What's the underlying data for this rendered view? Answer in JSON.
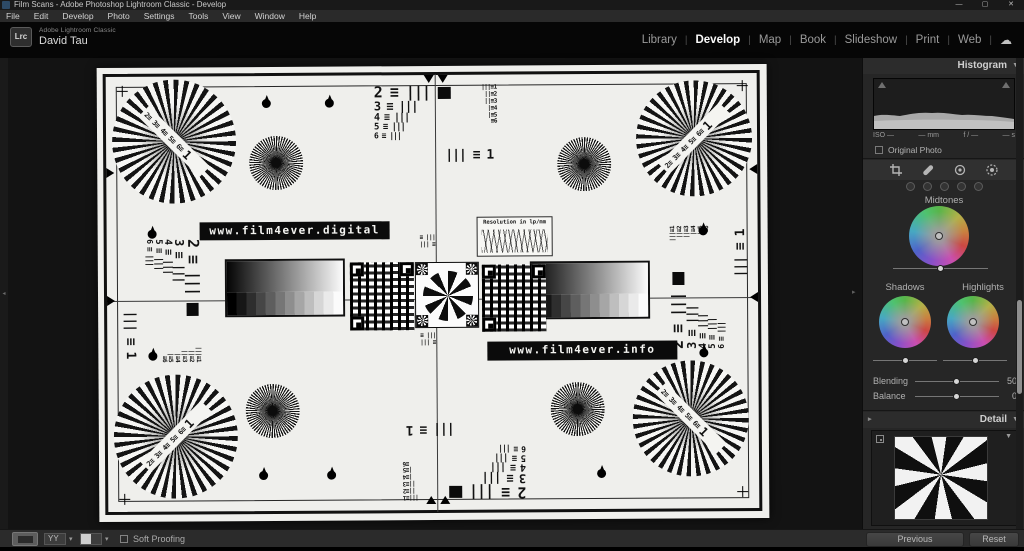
{
  "window": {
    "title": "Film Scans - Adobe Photoshop Lightroom Classic - Develop",
    "minimize": "—",
    "maximize": "▢",
    "close": "✕"
  },
  "menu": {
    "items": [
      "File",
      "Edit",
      "Develop",
      "Photo",
      "Settings",
      "Tools",
      "View",
      "Window",
      "Help"
    ]
  },
  "identity": {
    "logo_text": "Lrc",
    "app_name": "Adobe Lightroom Classic",
    "user_name": "David Tau"
  },
  "modules": {
    "items": [
      "Library",
      "Develop",
      "Map",
      "Book",
      "Slideshow",
      "Print",
      "Web"
    ],
    "active": "Develop",
    "cloud_icon": "☁",
    "separator": "|"
  },
  "panels": {
    "histogram": {
      "title": "Histogram",
      "disclosure": "▼",
      "exif": [
        "ISO —",
        "— mm",
        "f / —",
        "— s"
      ],
      "original_photo": "Original Photo"
    },
    "tool_icons": [
      "crop",
      "healing",
      "red-eye",
      "masking"
    ],
    "color_grading": {
      "midtones": "Midtones",
      "shadows": "Shadows",
      "highlights": "Highlights",
      "blending": "Blending",
      "blending_value": "50",
      "balance": "Balance",
      "balance_value": "0"
    },
    "detail": {
      "title": "Detail",
      "disclosure": "▼"
    }
  },
  "toolbar": {
    "soft_proofing": "Soft Proofing"
  },
  "footer_buttons": {
    "previous": "Previous",
    "reset": "Reset"
  },
  "rails": {
    "left_arrow": "◂",
    "right_arrow": "▸"
  },
  "chart": {
    "banner_top": "www.film4ever.digital",
    "banner_bottom": "www.film4ever.info",
    "resolution_title": "Resolution in lp/mm",
    "cluster": {
      "rows": [
        "2 ≡ |||",
        "3 ≡ |||",
        "4 ≡ |||",
        "5 ≡ |||",
        "6 ≡ |||"
      ],
      "mini_column": "|||≡1\n||≡2\n||≡3\n|≡4\n|≡5\n≡6",
      "footer": "||| ≡ 1"
    },
    "fan_text": "2≡ 3≡ 4≡ 5≡ 6≡",
    "fan_one": "1",
    "mini_bars": "≡ |||\n||| ≡"
  },
  "colors": {
    "panel_bg": "#262626",
    "image_bg": "#131313",
    "paper": "#efefec",
    "active_text": "#fafafa"
  }
}
